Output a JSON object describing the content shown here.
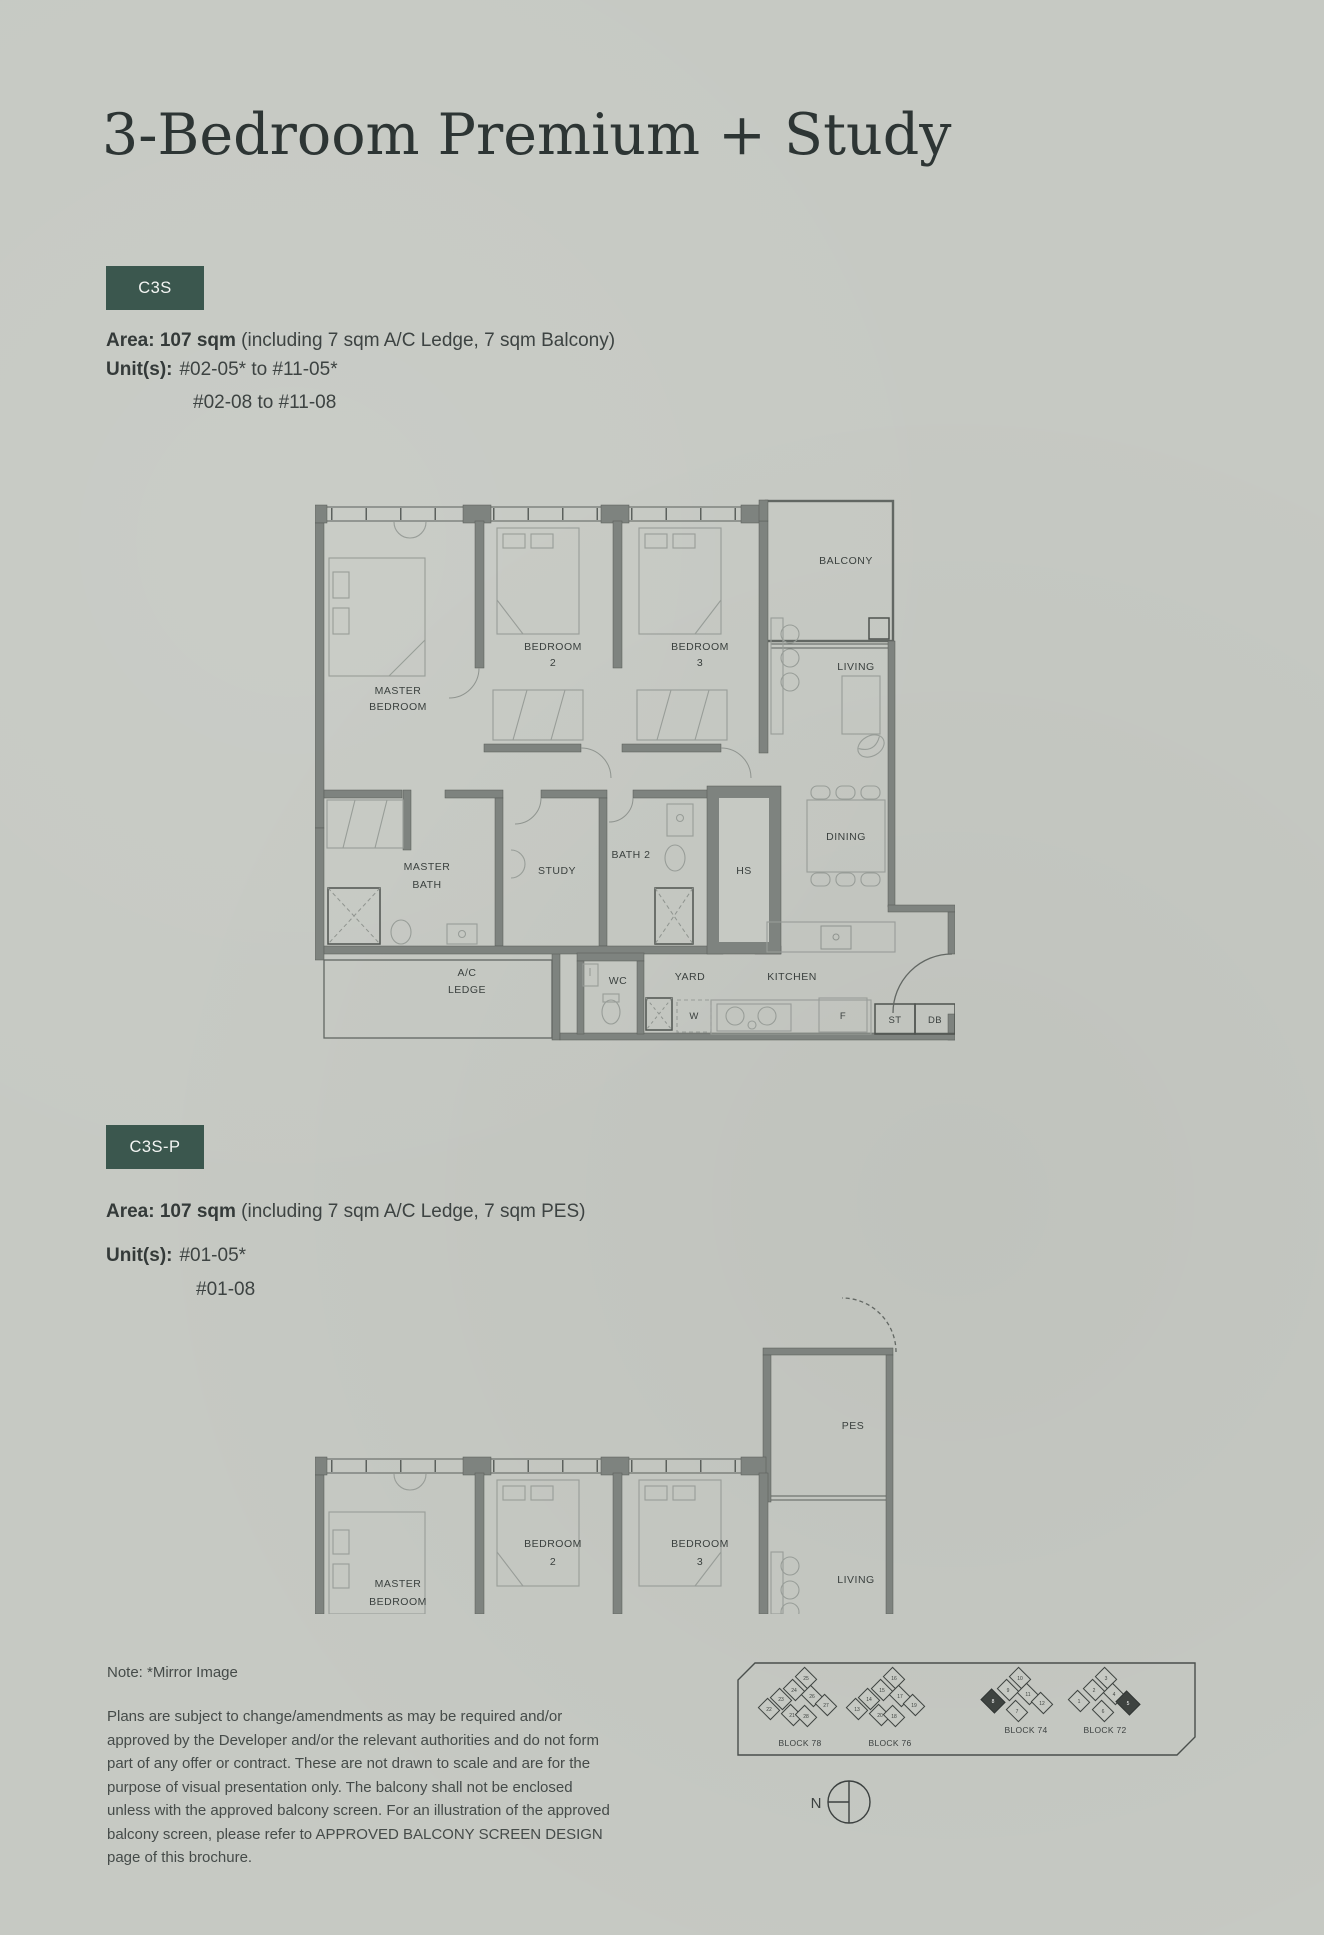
{
  "page": {
    "background": "#c6c9c3",
    "accent": "#3b574e",
    "ink": "#3d4342"
  },
  "header": {
    "title": "3-Bedroom Premium + Study"
  },
  "types": [
    {
      "code": "C3S",
      "area_bold": "Area: 107 sqm",
      "area_rest": " (including 7 sqm A/C Ledge, 7 sqm Balcony)",
      "units_label": "Unit(s):",
      "units_line1": "#02-05* to #11-05*",
      "units_line2": "#02-08 to #11-08"
    },
    {
      "code": "C3S-P",
      "area_bold": "Area: 107 sqm",
      "area_rest": " (including 7 sqm A/C Ledge, 7 sqm PES)",
      "units_label": "Unit(s):",
      "units_line1": "#01-05*",
      "units_line2": "#01-08"
    }
  ],
  "plan1": {
    "labels": {
      "balcony": "BALCONY",
      "living": "LIVING",
      "dining": "DINING",
      "master_bedroom": [
        "MASTER",
        "BEDROOM"
      ],
      "bedroom2": [
        "BEDROOM",
        "2"
      ],
      "bedroom3": [
        "BEDROOM",
        "3"
      ],
      "master_bath": [
        "MASTER",
        "BATH"
      ],
      "study": "STUDY",
      "bath2": "BATH 2",
      "hs": "HS",
      "ac_ledge": [
        "A/C",
        "LEDGE"
      ],
      "wc": "WC",
      "yard": "YARD",
      "kitchen": "KITCHEN",
      "washer": "W",
      "fridge": "F",
      "st": "ST",
      "db": "DB"
    }
  },
  "plan2": {
    "labels": {
      "pes": "PES",
      "living": "LIVING",
      "master_bedroom": [
        "MASTER",
        "BEDROOM"
      ],
      "bedroom2": [
        "BEDROOM",
        "2"
      ],
      "bedroom3": [
        "BEDROOM",
        "3"
      ]
    }
  },
  "footer": {
    "note": "Note: *Mirror Image",
    "disclaimer": "Plans are subject to change/amendments as may be required and/or approved by the Developer and/or the relevant authorities and do not form part of any offer or contract. These are not drawn to scale and are for the purpose of visual presentation only. The balcony shall not be enclosed unless with the approved balcony screen. For an illustration of the approved balcony screen, please refer to APPROVED BALCONY SCREEN DESIGN page of this brochure."
  },
  "siteplan": {
    "north": "N",
    "blocks": [
      {
        "name": "BLOCK 78",
        "units": [
          "25",
          "24",
          "23",
          "22",
          "21",
          "26",
          "27",
          "28"
        ]
      },
      {
        "name": "BLOCK 76",
        "units": [
          "16",
          "15",
          "14",
          "13",
          "20",
          "17",
          "19",
          "18"
        ]
      },
      {
        "name": "BLOCK 74",
        "units": [
          "10",
          "9",
          "8",
          "7",
          "11",
          "12"
        ]
      },
      {
        "name": "BLOCK 72",
        "units": [
          "3",
          "2",
          "1",
          "6",
          "4",
          "5"
        ]
      }
    ]
  }
}
